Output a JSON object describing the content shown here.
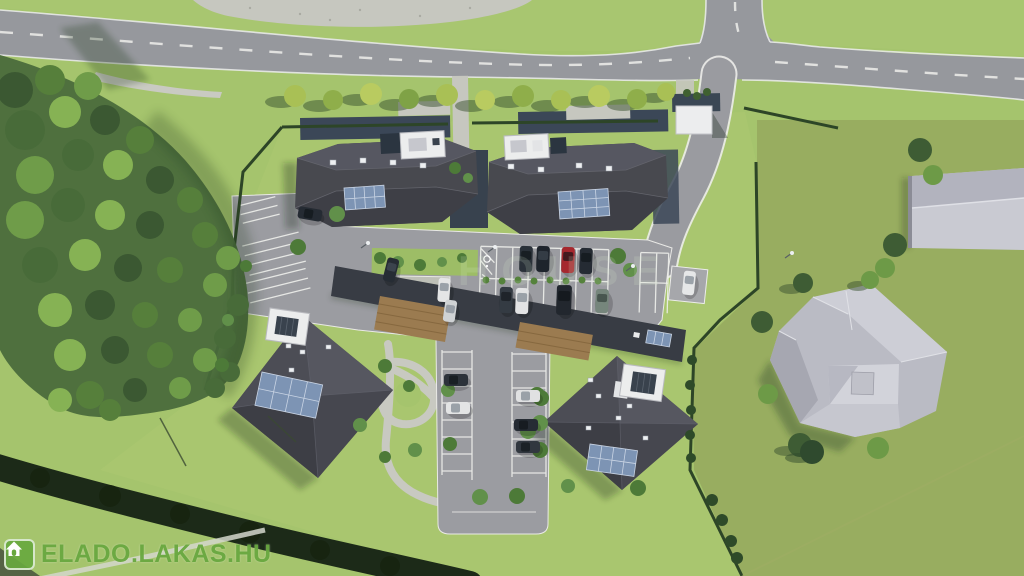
{
  "watermark": {
    "brand_text": "ELADO.LAKAS.HU",
    "icon": "house-icon"
  },
  "faint_watermark": {
    "text": "HOUSE"
  },
  "scene": {
    "view": "aerial bird's-eye 3D architectural rendering of a residential development",
    "site": {
      "buildings": [
        {
          "name": "apartment-building-northwest",
          "roof": "dark hip roof",
          "features": [
            "solar panel array",
            "white rooftop terrace structure",
            "skylights"
          ]
        },
        {
          "name": "apartment-building-northeast",
          "roof": "dark hip roof",
          "features": [
            "solar panel array",
            "white rooftop terrace structure",
            "skylights"
          ]
        },
        {
          "name": "apartment-building-west",
          "roof": "dark pyramidal hip roof",
          "features": [
            "solar panel array",
            "white rooftop terrace structure",
            "skylights"
          ]
        },
        {
          "name": "apartment-building-southeast",
          "roof": "dark pyramidal hip roof",
          "features": [
            "solar panel array",
            "white rooftop terrace structure",
            "skylights"
          ]
        },
        {
          "name": "single-storey-annex",
          "roof": "flat dark roof with two timber-brown sections and small solar array"
        }
      ],
      "parking": {
        "marked_bays": true,
        "disabled_parking_bay": true,
        "planted_medians": true,
        "cars_total": 18,
        "car_colors": {
          "dark": 10,
          "white_or_silver": 6,
          "red": 1,
          "sage_green": 1
        }
      },
      "landscape": [
        "dense forest strip on west side",
        "row of street trees along road",
        "dark perimeter hedges",
        "gravel footpaths",
        "lawns"
      ]
    },
    "surroundings": [
      "curved two-lane road with white dashed centerline",
      "T-junction with side road at top right",
      "large gray hip-roof house on east lawn",
      "light gray barn roof at right edge",
      "small white utility building near junction"
    ],
    "palette": {
      "lawn": "#a5c46d",
      "lawn_olive": "#8f9e58",
      "road": "#96989d",
      "asphalt": "#9b9ca1",
      "road_line": "#eceded",
      "roof_dark": "#48494f",
      "roof_gray": "#babbc4",
      "roof_gray_light": "#c9cad2",
      "solar": "#7d94b4",
      "gravel": "#c6c7bf",
      "wood": "#9b7b50",
      "hedge": "#2d4527",
      "forest": "#4a6b3c",
      "brand_green": "#69a53e"
    }
  }
}
